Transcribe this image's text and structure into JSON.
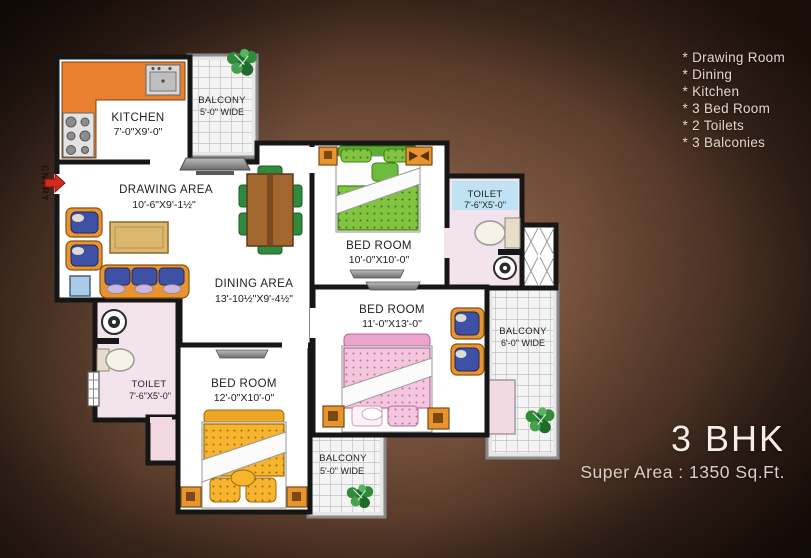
{
  "plan": {
    "entry_label": "ENTRY",
    "rooms": {
      "kitchen": {
        "name": "KITCHEN",
        "dims": "7'-0\"X9'-0\""
      },
      "balcony_top": {
        "name": "BALCONY",
        "dims": "5'-0\" WIDE"
      },
      "drawing": {
        "name": "DRAWING AREA",
        "dims": "10'-6\"X9'-1½\""
      },
      "dining": {
        "name": "DINING AREA",
        "dims": "13'-10½\"X9'-4½\""
      },
      "bedroom_top": {
        "name": "BED ROOM",
        "dims": "10'-0\"X10'-0\""
      },
      "toilet_top": {
        "name": "TOILET",
        "dims": "7'-6\"X5'-0\""
      },
      "balcony_right": {
        "name": "BALCONY",
        "dims": "6'-0\" WIDE"
      },
      "bedroom_right": {
        "name": "BED ROOM",
        "dims": "11'-0\"X13'-0\""
      },
      "toilet_left": {
        "name": "TOILET",
        "dims": "7'-6\"X5'-0\""
      },
      "bedroom_bottom": {
        "name": "BED ROOM",
        "dims": "12'-0\"X10'-0\""
      },
      "balcony_bottom": {
        "name": "BALCONY",
        "dims": "5'-0\" WIDE"
      }
    }
  },
  "features": {
    "items": [
      "* Drawing Room",
      "* Dining",
      "* Kitchen",
      "* 3 Bed Room",
      "* 2 Toilets",
      "* 3 Balconies"
    ]
  },
  "summary": {
    "title": "3 BHK",
    "subtitle": "Super Area : 1350 Sq.Ft."
  },
  "colors": {
    "wall": "#161616",
    "counter_orange": "#e8802f",
    "bed_green": "#82c341",
    "bed_pink": "#f4c6de",
    "bed_orange": "#f6b42f",
    "toilet_floor": "#f3e3ed",
    "toilet_header_blue": "#bfe3f4",
    "sofa_blue": "#3f51a5",
    "accent_orange": "#e8952f",
    "entry_arrow_red": "#d42a1e",
    "dining_chair_green": "#2e8b3d",
    "hall_pink": "#f3d9e2"
  }
}
